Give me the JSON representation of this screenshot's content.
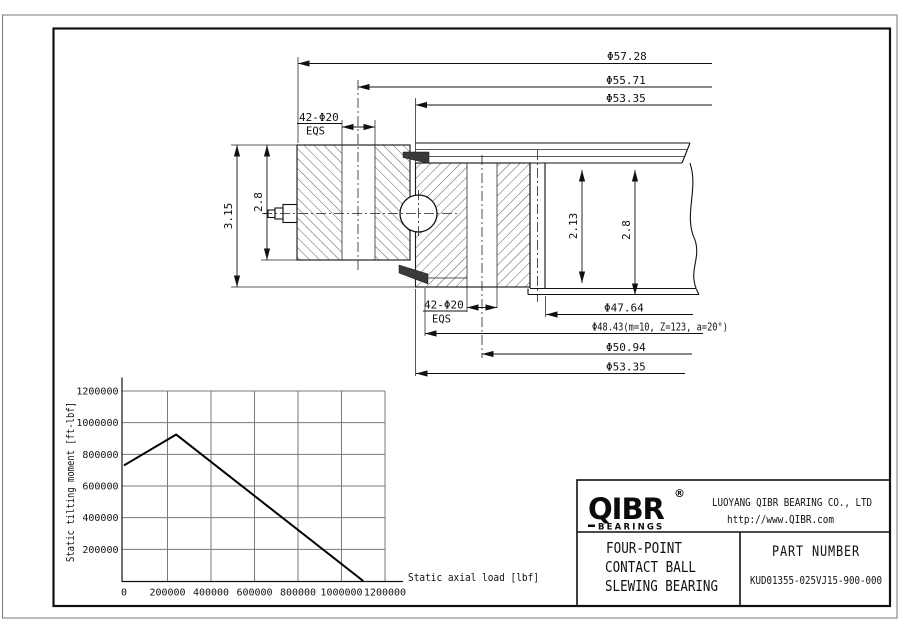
{
  "drawing": {
    "dim_outer_diameter": "Φ57.28",
    "dim_outer_bolt_circle": "Φ55.71",
    "dim_top_gap_diameter": "Φ53.35",
    "dim_outer_holes": "42-Φ20",
    "dim_outer_holes_note": "EQS",
    "dim_total_height": "3.15",
    "dim_outer_ring_height": "2.8",
    "dim_pilot_height": "2.13",
    "dim_inner_ring_height": "2.8",
    "dim_inner_holes": "42-Φ20",
    "dim_inner_holes_note": "EQS",
    "dim_bore_diameter": "Φ47.64",
    "dim_gear_pitch": "Φ48.43(m=10, Z=123, a=20°)",
    "dim_inner_bolt_circle": "Φ50.94",
    "dim_bottom_gap_diameter": "Φ53.35"
  },
  "chart_data": {
    "type": "line",
    "xlabel": "Static axial load [lbf]",
    "ylabel": "Static tilting moment [ft-lbf]",
    "xlim": [
      0,
      1200000
    ],
    "ylim": [
      0,
      1200000
    ],
    "x_ticks": [
      0,
      200000,
      400000,
      600000,
      800000,
      1000000,
      1200000
    ],
    "y_ticks": [
      200000,
      400000,
      600000,
      800000,
      1000000,
      1200000
    ],
    "grid": true,
    "legend": "none",
    "series": [
      {
        "name": "static capacity curve",
        "points": [
          [
            0,
            730000
          ],
          [
            240000,
            925000
          ],
          [
            1100000,
            0
          ]
        ]
      }
    ]
  },
  "title_block": {
    "logo_text": "QIBR",
    "logo_reg": "®",
    "logo_sub": "BEARINGS",
    "company": "LUOYANG QIBR BEARING CO., LTD",
    "website": "http://www.QIBR.com",
    "product_line1": "FOUR-POINT",
    "product_line2": "CONTACT BALL",
    "product_line3": "SLEWING BEARING",
    "part_number_label": "PART NUMBER",
    "part_number": "KUD01355-025VJ15-900-000"
  }
}
